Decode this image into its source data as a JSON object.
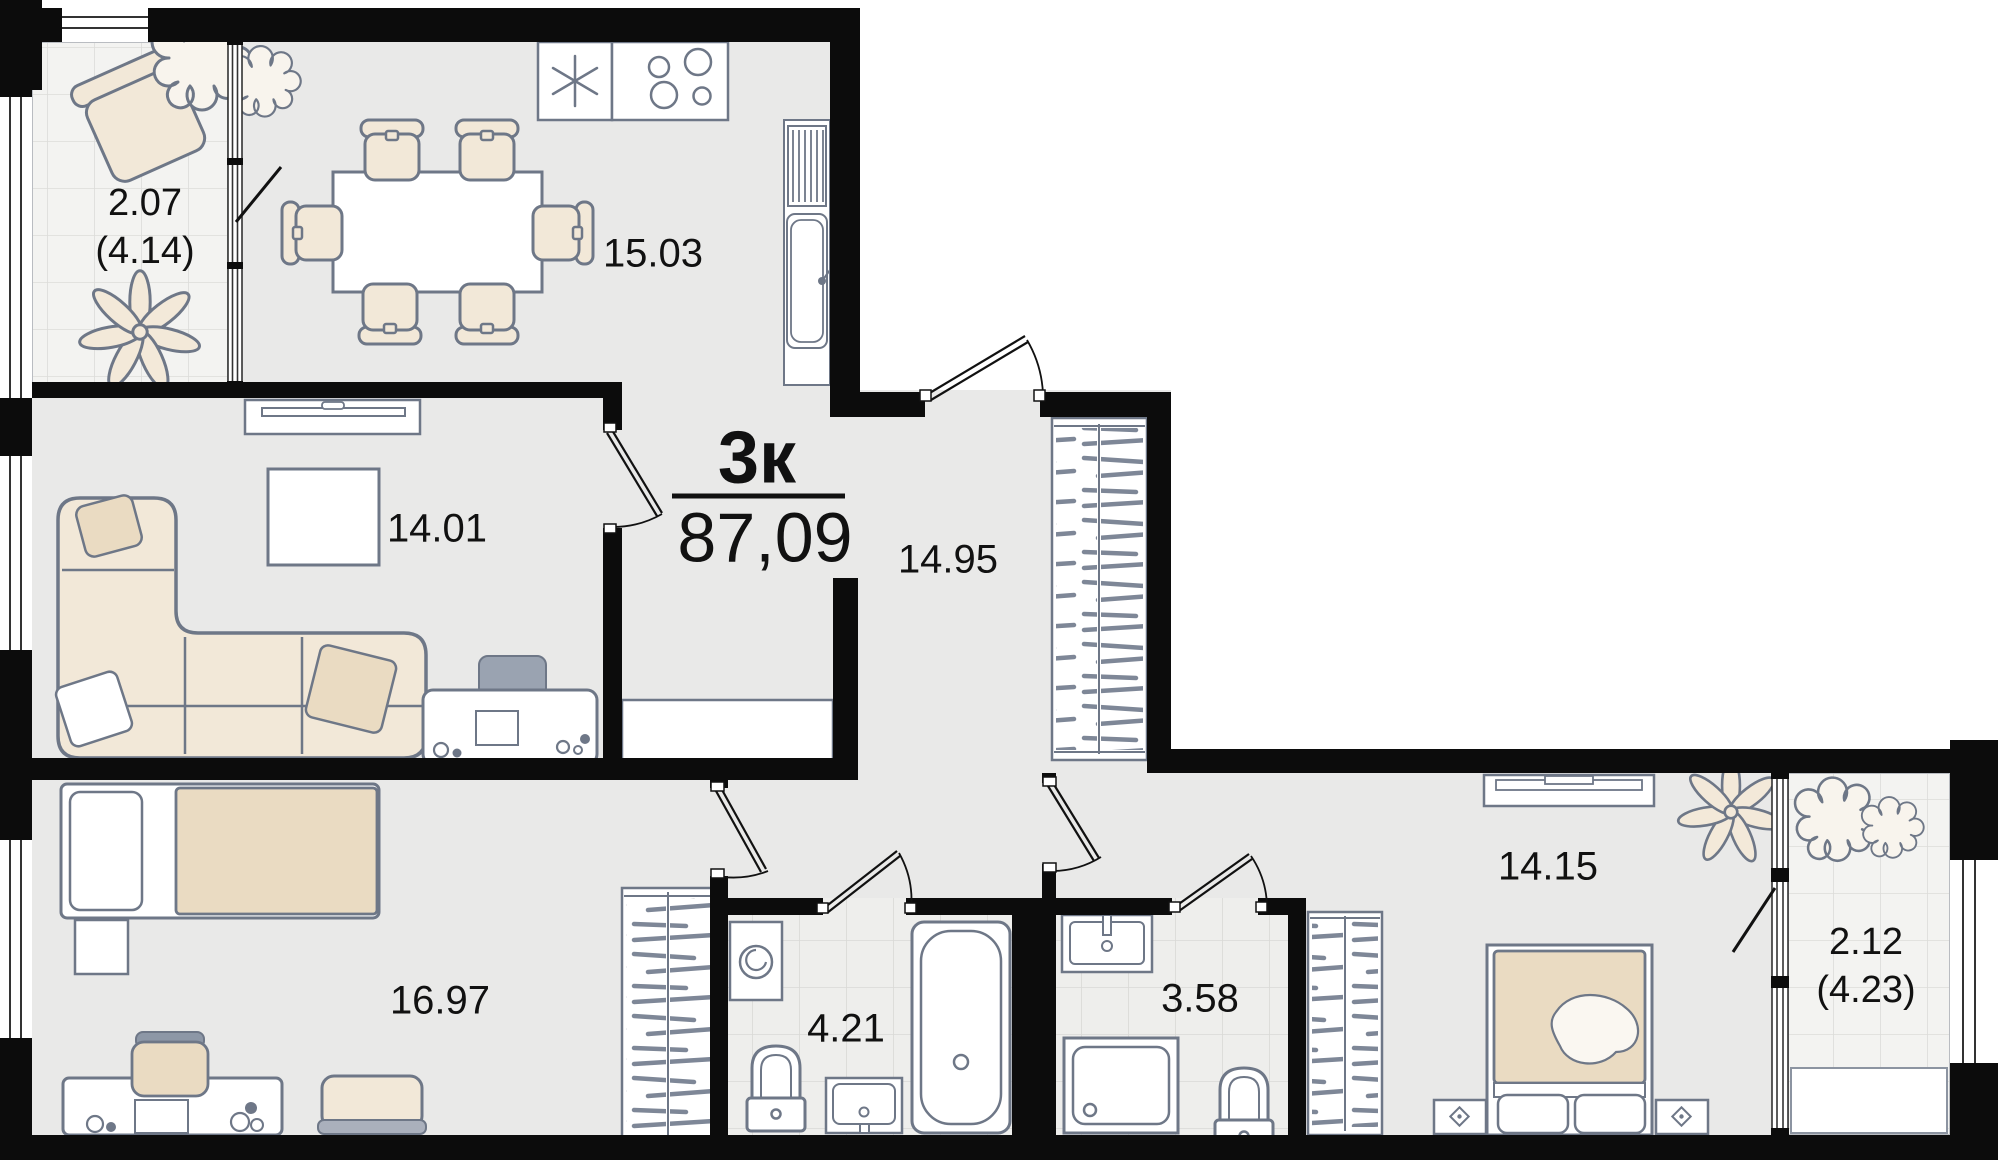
{
  "plan": {
    "title": {
      "type_label": "3к",
      "total_area": "87,09"
    },
    "rooms": {
      "kitchen": {
        "area": "15.03"
      },
      "living": {
        "area": "14.01"
      },
      "hallway": {
        "area": "14.95"
      },
      "bedroom1": {
        "area": "16.97"
      },
      "bathroom1": {
        "area": "4.21"
      },
      "bathroom2": {
        "area": "3.58"
      },
      "bedroom2": {
        "area": "14.15"
      }
    },
    "balconies": {
      "balcony1": {
        "area": "2.07",
        "area_total": "(4.14)"
      },
      "balcony2": {
        "area": "2.12",
        "area_total": "(4.23)"
      }
    },
    "colors": {
      "wall": "#0c0c0c",
      "outline": "#6e7787",
      "floor": "#e9e9e8",
      "balcony_tile": "#f3f3f1",
      "bath_tile": "#eeeeec",
      "tile_line": "#d9d9d6",
      "furniture_cream": "#f2e8d8",
      "furniture_tan": "#eadbc2",
      "accent_dark": "#9aa3b1",
      "text": "#111111"
    }
  }
}
